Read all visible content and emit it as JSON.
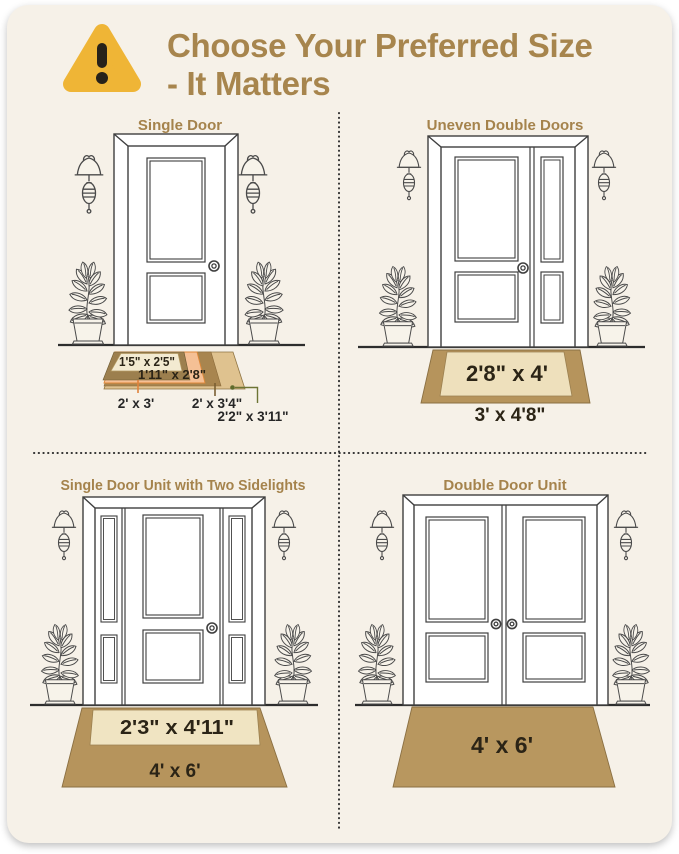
{
  "header": {
    "icon": "warning-triangle-icon",
    "title_line1": "Choose Your Preferred Size",
    "title_line2": "- It Matters"
  },
  "sections": [
    {
      "id": "single-door",
      "title": "Single Door",
      "mats": [
        "1'5\" x 2'5\"",
        "1'11\" x 2'8\"",
        "2' x 3'",
        "2' x 3'4\"",
        "2'2\" x 3'11\""
      ]
    },
    {
      "id": "uneven-double-doors",
      "title": "Uneven Double Doors",
      "mats": [
        "2'8\" x 4'",
        "3' x 4'8\""
      ]
    },
    {
      "id": "single-door-two-sidelights",
      "title": "Single Door Unit with Two Sidelights",
      "mats": [
        "2'3\" x 4'11\"",
        "4' x 6'"
      ]
    },
    {
      "id": "double-door-unit",
      "title": "Double Door Unit",
      "mats": [
        "4' x 6'"
      ]
    }
  ],
  "colors": {
    "background": "#f6f1e8",
    "accent_brown": "#a7854d",
    "warning_yellow": "#efb536",
    "mat_tan": "#b6945c",
    "mat_cream": "#eee0bc",
    "mat_inner_cream": "#f3ead1",
    "mat_peach": "#f5c095",
    "mat_khaki": "#9c7f4e",
    "mat_brown": "#a8854f",
    "mat_light_tan": "#dfc28f",
    "leader_orange": "#e0823c",
    "leader_olive": "#6d7434",
    "line_dark": "#3f3f3f"
  }
}
